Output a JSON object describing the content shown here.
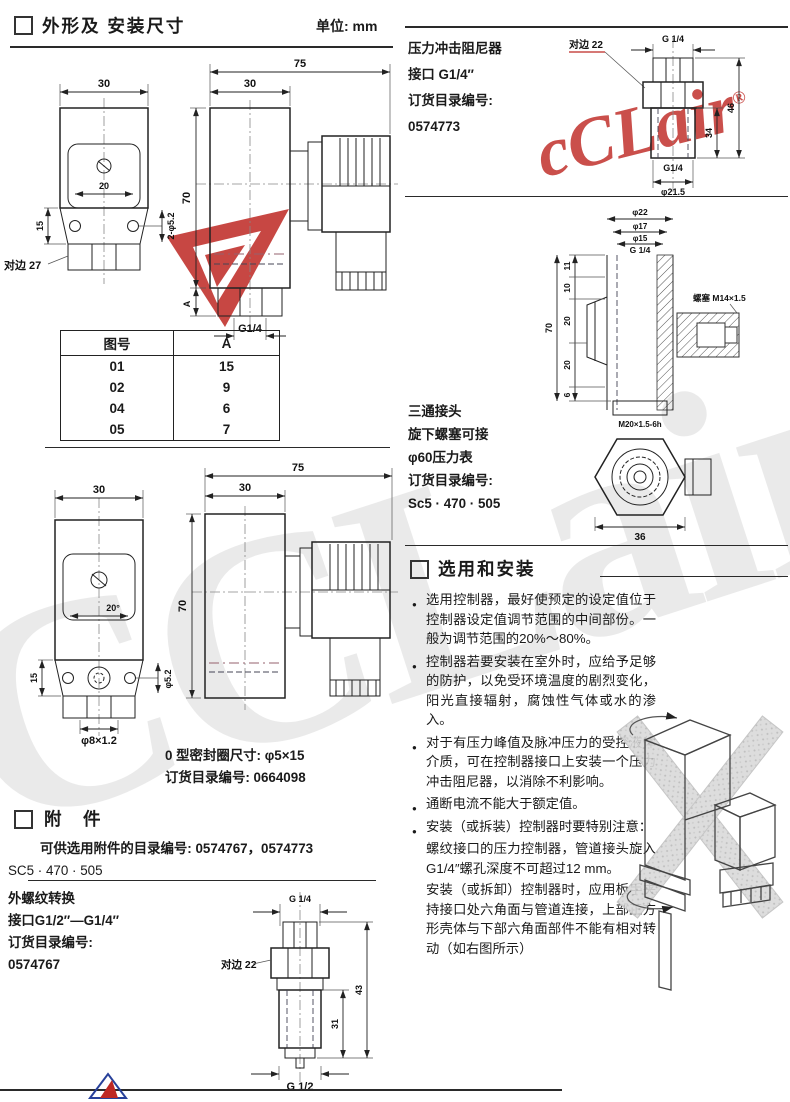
{
  "page": {
    "unit": "单位: mm"
  },
  "dims_section": {
    "title": "外形及 安装尺寸"
  },
  "drawing1": {
    "front": {
      "w30": "30",
      "w20": "20",
      "holes": "2-φ5.2",
      "h15": "15",
      "hex27": "对边 27"
    },
    "side": {
      "w75": "75",
      "w30": "30",
      "h70": "70",
      "dimA": "A",
      "thread": "G1/4"
    }
  },
  "table": {
    "col1": "图号",
    "col2": "A",
    "rows": [
      {
        "no": "01",
        "a": "15"
      },
      {
        "no": "02",
        "a": "9"
      },
      {
        "no": "04",
        "a": "6"
      },
      {
        "no": "05",
        "a": "7"
      }
    ]
  },
  "drawing2": {
    "front": {
      "w30": "30",
      "angle": "20°",
      "hole": "φ5.2",
      "h15": "15",
      "bottom": "φ8×1.2"
    },
    "side": {
      "w75": "75",
      "w30": "30",
      "h70": "70"
    }
  },
  "oring": {
    "line1": "0 型密封圈尺寸: φ5×15",
    "line2": "订货目录编号: 0664098"
  },
  "accessories": {
    "title": "附　件",
    "line1": "可供选用附件的目录编号: 0574767，0574773",
    "line2": "SC5 · 470 · 505"
  },
  "thread_conv": {
    "line1": "外螺纹转换",
    "line2": "接口G1/2″—G1/4″",
    "line3": "订货目录编号:",
    "line4": "0574767"
  },
  "drawing3": {
    "g14": "G 1/4",
    "hex22": "对边 22",
    "d31": "31",
    "d43": "43",
    "g12": "G 1/2"
  },
  "damper": {
    "line1": "压力冲击阻尼器",
    "line2": "接口 G1/4″",
    "line3": "订货目录编号:",
    "line4": "0574773",
    "labels": {
      "hex22": "对边 22",
      "g14top": "G 1/4",
      "d34": "34",
      "d46": "46",
      "g14bot": "G1/4",
      "dia": "φ21.5"
    }
  },
  "tee": {
    "line1": "三通接头",
    "line2": "旋下螺塞可接",
    "line3": "φ60压力表",
    "line4": "订货目录编号:",
    "line5": "Sc5 · 470 · 505",
    "labels": {
      "d22": "φ22",
      "d17": "φ17",
      "d15": "φ15",
      "g14": "G 1/4",
      "d11": "11",
      "d10": "10",
      "d20a": "20",
      "d20b": "20",
      "d6": "6",
      "d70": "70",
      "plug": "螺塞 M14×1.5",
      "m20": "M20×1.5-6h",
      "d36": "36"
    }
  },
  "selection": {
    "title": "选用和安装",
    "bullet_char": "●",
    "bullets": [
      "选用控制器，最好使预定的设定值位于控制器设定值调节范围的中间部份。一般为调节范围的20%～80%。",
      "控制器若要安装在室外时，应给予足够的防护，以免受环境温度的剧烈变化，阳光直接辐射，腐蚀性气体或水的渗入。",
      "对于有压力峰值及脉冲压力的受控液体介质，可在控制器接口上安装一个压力冲击阻尼器，以消除不利影响。",
      "通断电流不能大于额定值。",
      "安装（或拆装）控制器时要特别注意："
    ],
    "continuation": [
      "螺纹接口的压力控制器，管道接头旋入G1/4″螺孔深度不可超过12 mm。",
      "安装（或拆卸）控制器时，应用板手夹持接口处六角面与管道连接，上部正方形壳体与下部六角面部件不能有相对转动（如右图所示）"
    ]
  },
  "watermark": {
    "brand_script": "cCLair",
    "reg": "®",
    "brand_big": "CCLair"
  },
  "colors": {
    "brand_red": "#be2823",
    "watermark_gray": "#d7d7d7",
    "line": "#222222"
  }
}
